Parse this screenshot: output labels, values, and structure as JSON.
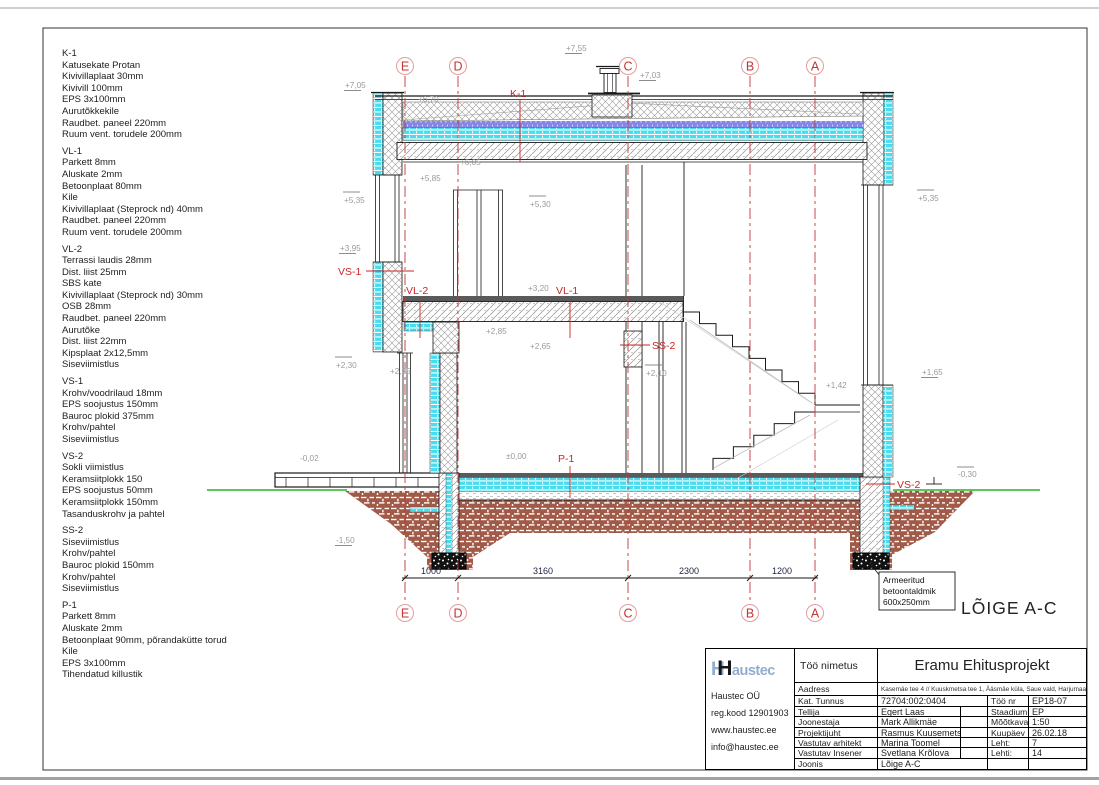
{
  "specs": [
    {
      "title": "K-1",
      "lines": [
        "Katusekate Protan",
        "Kivivillaplaat 30mm",
        "Kivivill 100mm",
        "EPS 3x100mm",
        "Aurutõkkekile",
        "Raudbet. paneel 220mm",
        "Ruum vent. torudele 200mm"
      ]
    },
    {
      "title": "VL-1",
      "lines": [
        "Parkett 8mm",
        "Aluskate 2mm",
        "Betoonplaat 80mm",
        "Kile",
        "Kivivillaplaat (Steprock nd) 40mm",
        "Raudbet. paneel 220mm",
        "Ruum vent. torudele 200mm"
      ]
    },
    {
      "title": "VL-2",
      "lines": [
        "Terrassi laudis 28mm",
        "Dist. liist 25mm",
        "SBS kate",
        "Kivivillaplaat (Steprock nd) 30mm",
        "OSB 28mm",
        "Raudbet. paneel 220mm",
        "Aurutõke",
        "Dist. liist 22mm",
        "Kipsplaat 2x12,5mm",
        "Siseviimistlus"
      ]
    },
    {
      "title": "VS-1",
      "lines": [
        "Krohv/voodrilaud 18mm",
        "EPS soojustus 150mm",
        "Bauroc plokid 375mm",
        "Krohv/pahtel",
        "Siseviimistlus"
      ]
    },
    {
      "title": "VS-2",
      "lines": [
        "Sokli viimistlus",
        "Keramsiitplokk 150",
        "EPS soojustus 50mm",
        "Keramsiitplokk 150mm",
        "Tasanduskrohv ja pahtel"
      ]
    },
    {
      "title": "SS-2",
      "lines": [
        "Siseviimistlus",
        "Krohv/pahtel",
        "Bauroc plokid 150mm",
        "Krohv/pahtel",
        "Siseviimistlus"
      ]
    },
    {
      "title": "P-1",
      "lines": [
        "Parkett 8mm",
        "Aluskate 2mm",
        "Betoonplaat 90mm, põrandakütte torud",
        "Kile",
        "EPS 3x100mm",
        "Tihendatud killustik"
      ]
    }
  ],
  "drawing": {
    "section_title": "LÕIGE A-C",
    "grid": [
      "E",
      "D",
      "C",
      "B",
      "A"
    ],
    "dimensions": [
      "1000",
      "3160",
      "2300",
      "1200"
    ],
    "marks": [
      "+7,05",
      "+7,55",
      "+7,03",
      "+6,70",
      "+6,05",
      "+5,85",
      "+5,35",
      "+5,30",
      "+5,35",
      "+3,95",
      "+3,20",
      "+2,85",
      "+2,65",
      "+2,30",
      "+2,25",
      "+2,10",
      "+1,42",
      "+1,65",
      "±0,00",
      "-0,02",
      "-1,50",
      "-0,30"
    ],
    "labels": {
      "k1": "K-1",
      "vs1": "VS-1",
      "vl2": "VL-2",
      "vl1": "VL-1",
      "ss2": "SS-2",
      "p1": "P-1",
      "vs2": "VS-2"
    },
    "annotation": [
      "Armeeritud",
      "betoontaldmik",
      "600x250mm"
    ],
    "colors": {
      "grid_red": "#c23636",
      "label_red": "#cc2525",
      "insulation_cyan": "#49dcee",
      "soil_brown": "#a15a47",
      "terrain_green": "#29b229",
      "layer_blue": "#8486e8"
    }
  },
  "tb": {
    "company": {
      "logo": {
        "h1": "H",
        "h2": "H",
        "rest": "austec"
      },
      "name": "Haustec OÜ",
      "reg": "reg.kood 12901903",
      "web": "www.haustec.ee",
      "email": "info@haustec.ee"
    },
    "project_label": "Töö nimetus",
    "project": "Eramu Ehitusprojekt",
    "address_label": "Aadress",
    "address": "Kasemäe tee 4 // Kuuskmetsa tee 1,  Ääsmäe küla, Saue vald, Harjumaa",
    "rows": [
      {
        "l": "Kat. Tunnus",
        "v": "72704:002:0404",
        "l2": "Töö nr",
        "v2": "EP18-07"
      },
      {
        "l": "Tellija",
        "v": "Egert Laas",
        "l2": "Staadium",
        "v2": "EP"
      },
      {
        "l": "Joonestaja",
        "v": "Mark Allikmäe",
        "l2": "Mõõtkava",
        "v2": "1:50"
      },
      {
        "l": "Projektijuht",
        "v": "Rasmus Kuusemets",
        "l2": "Kuupäev",
        "v2": "26.02.18"
      },
      {
        "l": "Vastutav arhitekt",
        "v": "Marina Toomel",
        "l2": "Leht:",
        "v2": "7"
      },
      {
        "l": "Vastutav Insener",
        "v": "Svetlana Krõlova",
        "l2": "Lehti:",
        "v2": "14"
      }
    ],
    "joonis_label": "Joonis",
    "joonis": "Lõige A-C"
  }
}
